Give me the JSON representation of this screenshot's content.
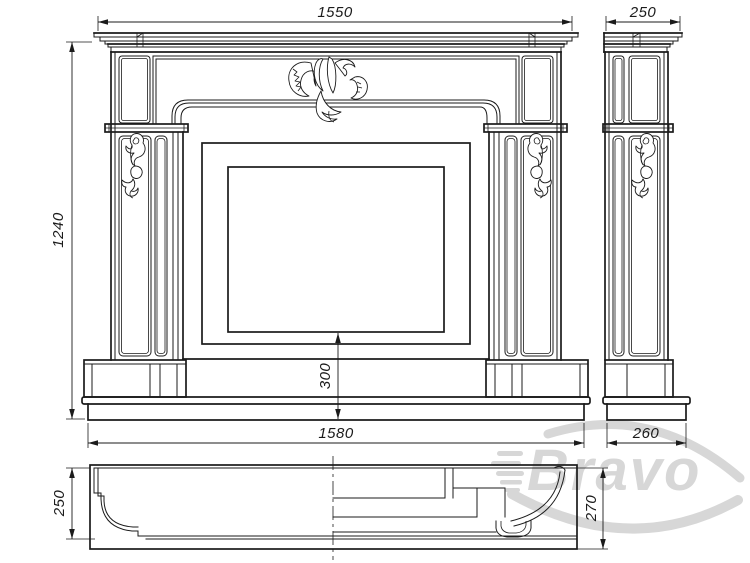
{
  "drawing": {
    "type": "technical-drawing",
    "subject": "fireplace-mantel-three-views",
    "background": "#ffffff",
    "line_color": "#1b1b1b",
    "views": {
      "front": {
        "dimensions": {
          "shelf_width": "1550",
          "overall_height": "1240",
          "hearth_height": "300",
          "base_width": "1580"
        }
      },
      "side": {
        "dimensions": {
          "shelf_depth": "250",
          "base_depth": "260"
        }
      },
      "plan": {
        "dimensions": {
          "body_depth": "250",
          "overall_depth": "270"
        }
      }
    },
    "watermark": {
      "text": "Bravo",
      "color": "#d7d7d7"
    }
  }
}
